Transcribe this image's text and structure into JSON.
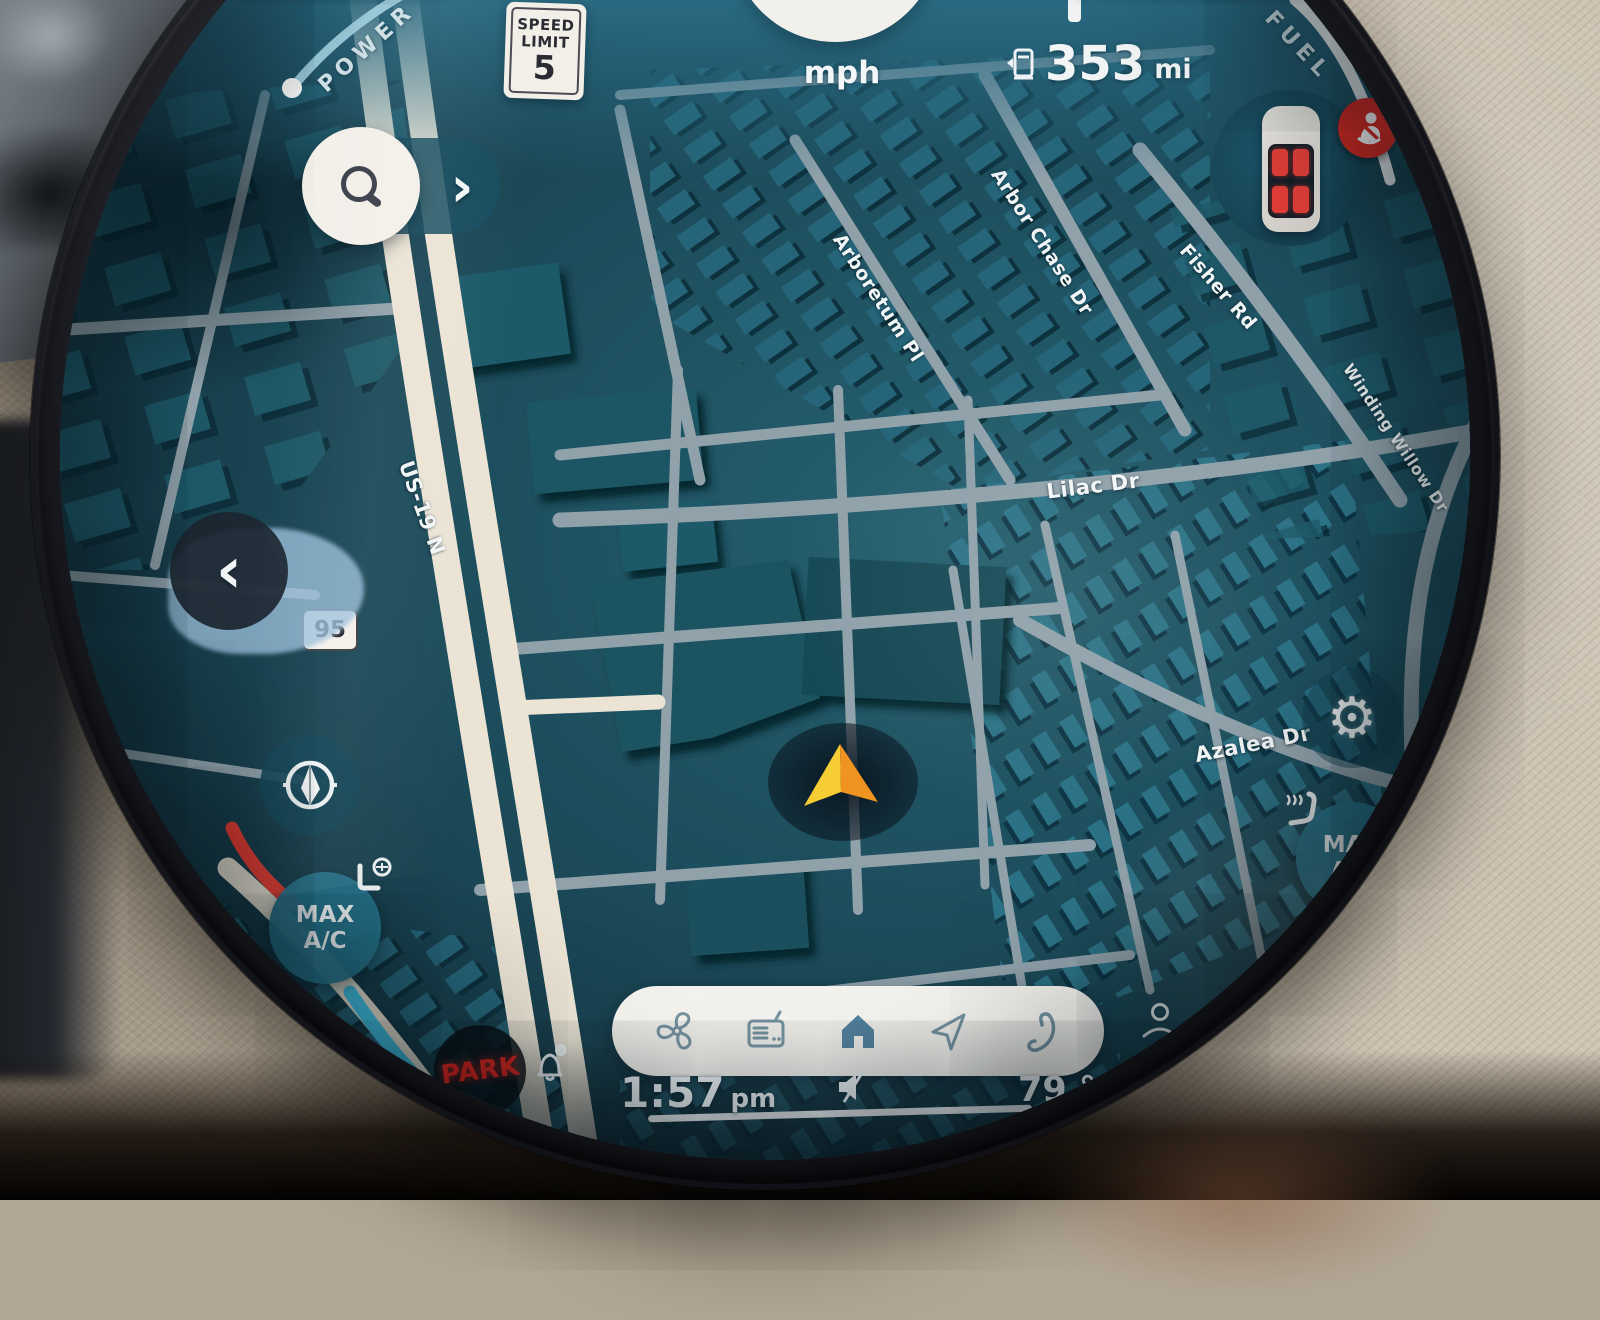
{
  "display": {
    "cluster": {
      "power_label": "POWER",
      "fuel_label": "FUEL",
      "speed_value": "0",
      "speed_unit": "mph",
      "range_value": "353",
      "range_unit": "mi",
      "speed_limit": {
        "line1": "SPEED",
        "line2": "LIMIT",
        "value": "5"
      }
    },
    "map": {
      "streets": {
        "arboretum": "Arboretum Pl",
        "arbor_chase": "Arbor Chase Dr",
        "fisher": "Fisher Rd",
        "winding_willow": "Winding Willow Dr",
        "lilac": "Lilac Dr",
        "azalea": "Azalea Dr",
        "highway": "US-19 N",
        "route_shield": "95"
      }
    },
    "climate": {
      "max_line1": "MAX",
      "max_line2": "A/C"
    },
    "status": {
      "gear": "PARK",
      "time": "1:57",
      "meridiem": "pm",
      "temperature": "79 °F"
    }
  },
  "icons": {
    "chevron_right": "›",
    "chevron_left": "‹",
    "gear_glyph": "⚙"
  },
  "colors": {
    "accent_red": "#ee3b31",
    "accent_cyan": "#44c8ec",
    "park_red": "#e5231c",
    "seat_red": "#e8403a",
    "map_bg": "#1b4856",
    "road_cream": "#ebe4d5",
    "road_gray": "#90a1aa"
  }
}
